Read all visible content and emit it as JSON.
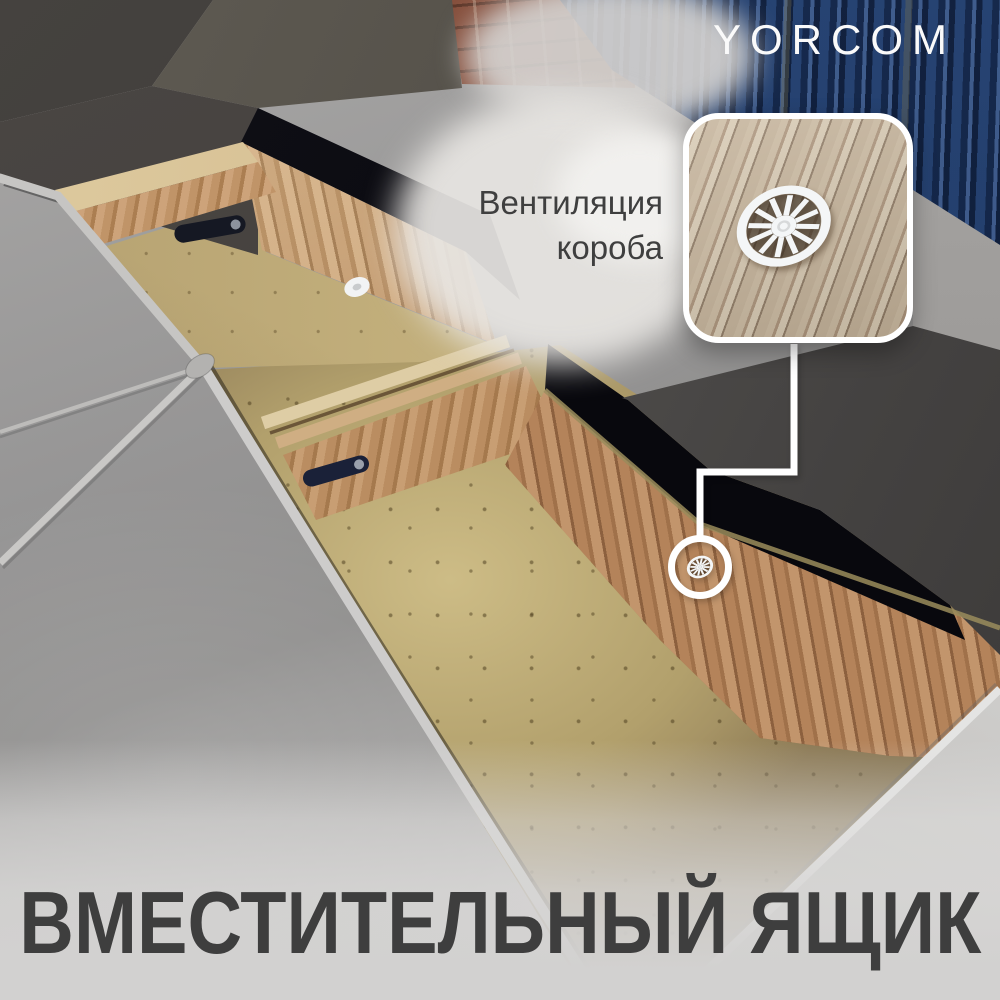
{
  "brand": {
    "logo": "YORCOM"
  },
  "callout": {
    "label_line1": "Вентиляция",
    "label_line2": "короба",
    "icon": "ventilation-grommet",
    "target": "vent-on-storage-box-wall"
  },
  "headline": {
    "text": "ВМЕСТИТЕЛЬНЫЙ ЯЩИК"
  },
  "scene": {
    "description_parts": {
      "sofa_fabric": "gray velvet",
      "storage_box": "oak wood open storage boxes with MDF bottom",
      "background_wall": "dark blue corrugated container wall and brick",
      "hardware": "black leather lift straps, white plastic vent grommets"
    }
  },
  "colors": {
    "brand_text": "#FAFAFA",
    "headline_text": "#3E3E3E",
    "label_text": "#3F3F3F",
    "callout_border": "#FFFFFF",
    "connector": "#FFFFFF",
    "vent_white": "#F4F6F7",
    "wood_oak": "#B98B61",
    "wood_mdf": "#BFA877",
    "callout_wood": "#C4B299",
    "wall_blue": "#1E3A66",
    "brick": "#7D4A38",
    "velvet_gray": "#9C9C9C",
    "panel_dark": "#4A4744",
    "gap_black": "#0B0B10"
  }
}
